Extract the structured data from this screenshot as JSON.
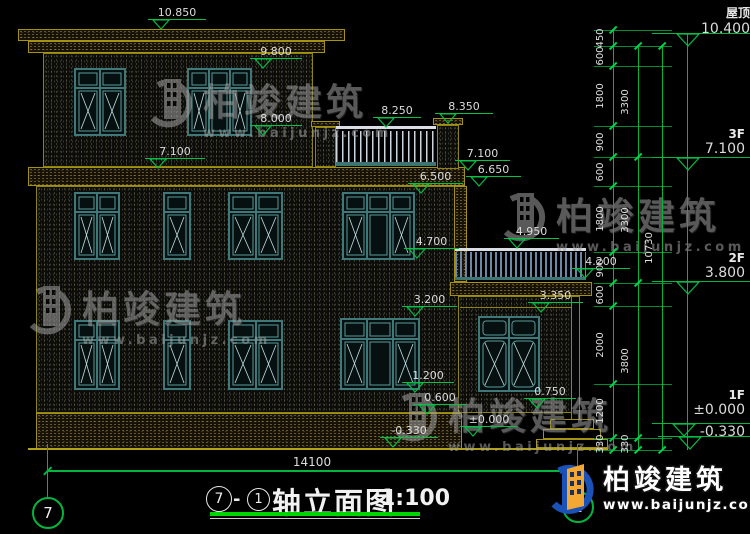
{
  "watermark": {
    "brand": "柏竣建筑",
    "url": "www.baijunjz.com"
  },
  "logo": {
    "brand": "柏竣建筑",
    "url": "www.baijunjz.com"
  },
  "facade_markers": [
    "10.850",
    "9.800",
    "8.000",
    "7.100",
    "8.250",
    "8.350",
    "7.100",
    "6.650",
    "6.500",
    "4.950",
    "4.700",
    "4.200",
    "3.350",
    "3.200",
    "1.200",
    "0.600",
    "0.750",
    "±0.000",
    "-0.330"
  ],
  "right_markers": {
    "roof": {
      "label": "屋顶",
      "value": "10.400"
    },
    "f3": {
      "label": "3F",
      "value": "7.100"
    },
    "f2": {
      "label": "2F",
      "value": "3.800"
    },
    "f1": {
      "label": "1F",
      "value": "±0.000",
      "value_below": "-0.330"
    }
  },
  "dims": {
    "inner": [
      "450",
      "600",
      "1800",
      "900",
      "600",
      "1800",
      "900",
      "600",
      "2000",
      "1200",
      "330"
    ],
    "middle": [
      "3300",
      "3300",
      "3800",
      "330"
    ],
    "outer": [
      "10730"
    ],
    "bottom": "14100"
  },
  "title_block": {
    "axis_left": "7",
    "dash": "-",
    "axis_right": "1",
    "name": "轴立面图",
    "scale": "1:100"
  },
  "axis_bubbles": {
    "left": "7",
    "right": "1"
  }
}
